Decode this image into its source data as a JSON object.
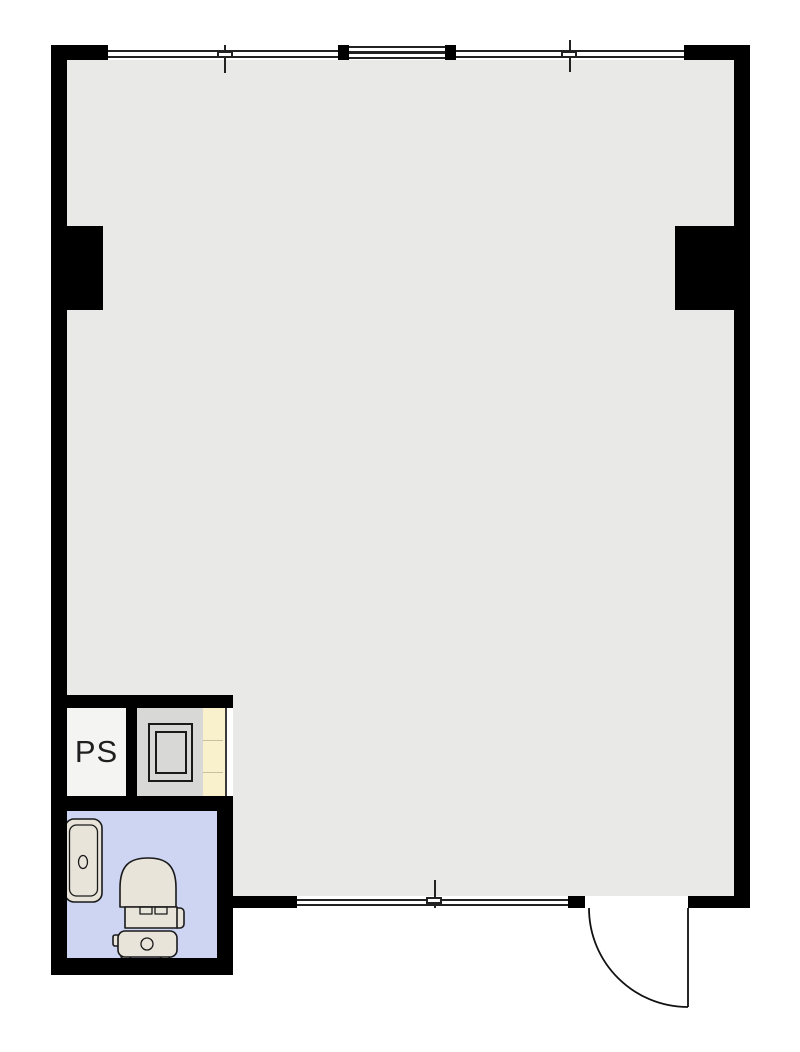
{
  "plan": {
    "type": "floorplan",
    "rooms": {
      "pipe_space": {
        "label": "PS"
      },
      "main_room": {
        "label": ""
      },
      "bathroom": {
        "label": ""
      },
      "heater_space": {
        "label": ""
      }
    },
    "fixtures": [
      "bathtub",
      "toilet",
      "water-heater"
    ],
    "openings": {
      "top_windows": 3,
      "bottom_windows": 1,
      "entry_doors": 1
    },
    "colors": {
      "wall": "#000000",
      "floor": "#e9e9e8",
      "bath": "#cdd5f3",
      "equip": "#d8d8d6",
      "ps": "#f4f4f2",
      "shelf": "#f9f0cc",
      "fixture": "#e8e4da",
      "line": "#1a1a1a",
      "bg": "#ffffff"
    }
  }
}
